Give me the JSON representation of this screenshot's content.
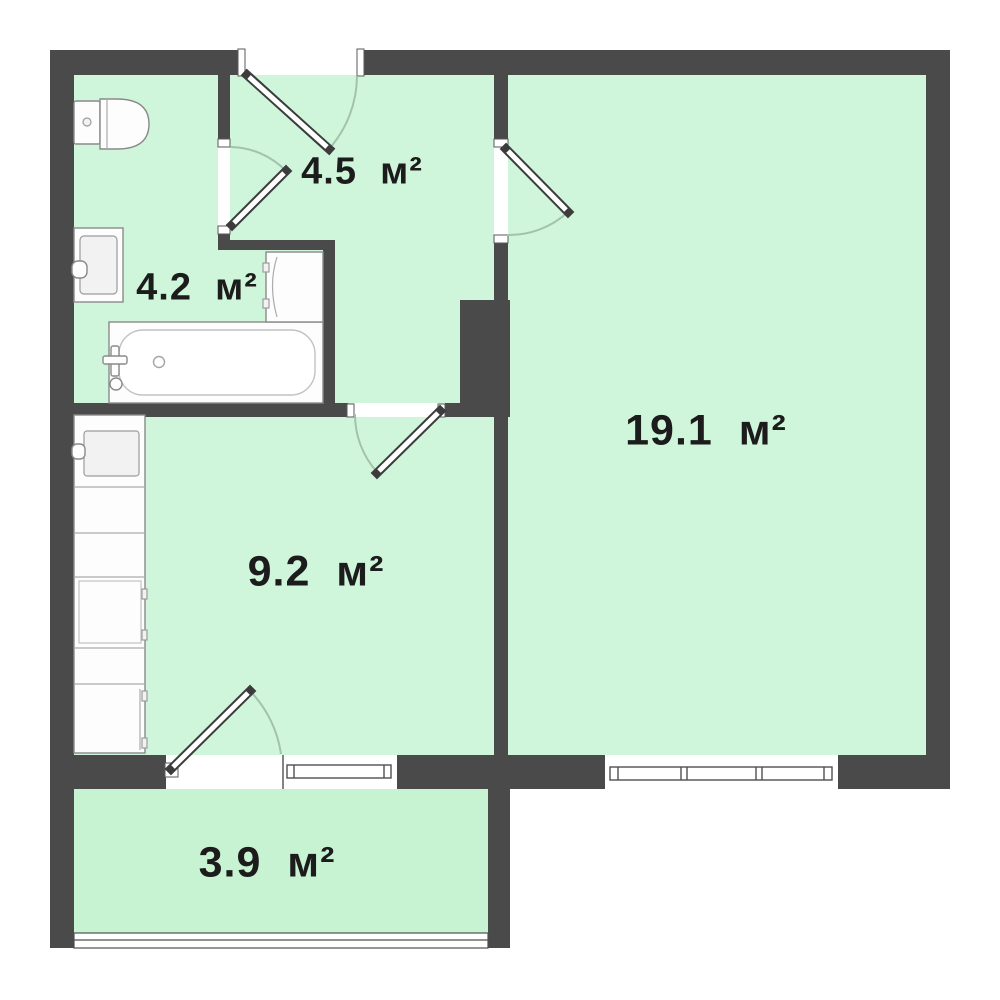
{
  "title": "Apartment floor plan",
  "unit_suffix": "м²",
  "colors": {
    "background": "#ffffff",
    "wall": "#4a4a4a",
    "room_fill": "#cff5da",
    "balcony_fill": "#c7f3d2",
    "door_outline": "#3c3c3c",
    "furniture_outline": "#8a8a8a",
    "swing_arc": "#a3c2ae",
    "label_text": "#1c1c1c"
  },
  "rooms": {
    "hallway": {
      "name": "hallway",
      "area_value": "4.5",
      "area_label": "4.5  м²"
    },
    "bathroom": {
      "name": "bathroom",
      "area_value": "4.2",
      "area_label": "4.2  м²"
    },
    "living_room": {
      "name": "living room",
      "area_value": "19.1",
      "area_label": "19.1  м²"
    },
    "kitchen": {
      "name": "kitchen",
      "area_value": "9.2",
      "area_label": "9.2  м²"
    },
    "balcony": {
      "name": "balcony",
      "area_value": "3.9",
      "area_label": "3.9  м²"
    }
  }
}
